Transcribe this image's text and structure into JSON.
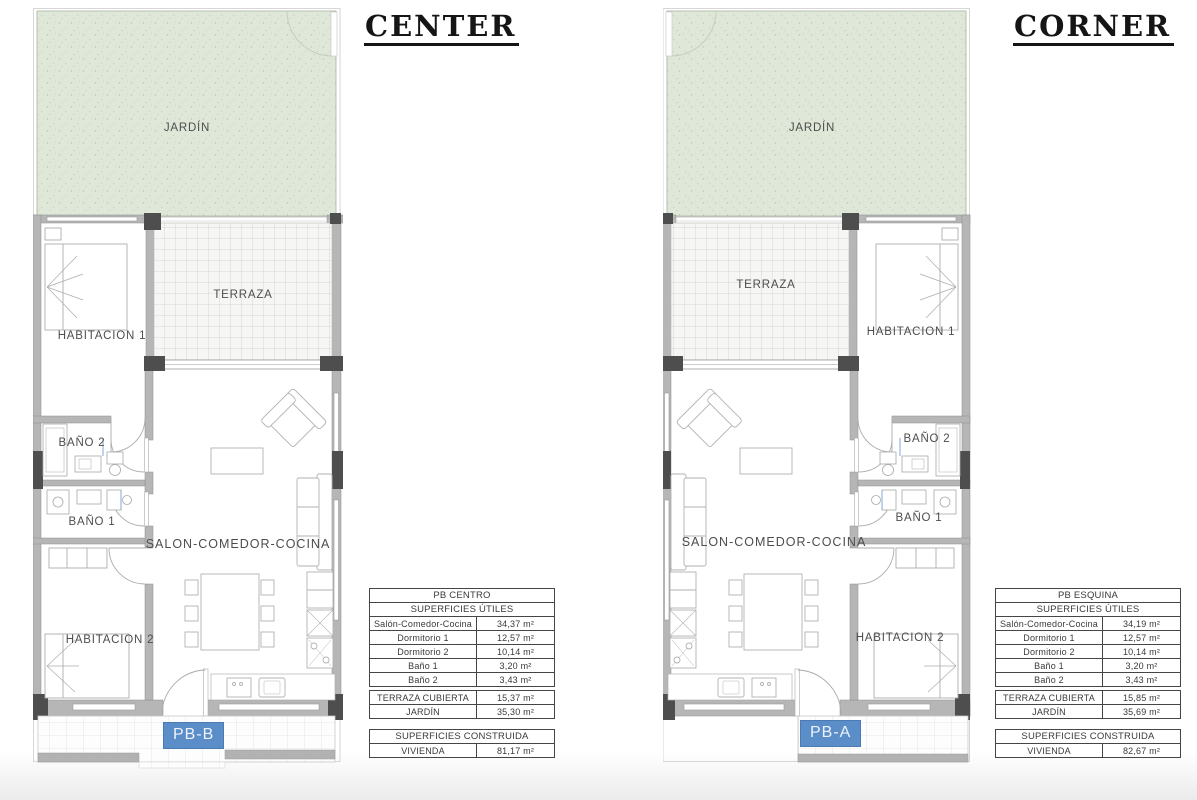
{
  "plans": {
    "center": {
      "title": "CENTER",
      "unit_label": "PB-B",
      "rooms": {
        "jardin": "JARDÍN",
        "terraza": "TERRAZA",
        "habitacion1": "HABITACION 1",
        "bano2": "BAÑO 2",
        "bano1": "BAÑO 1",
        "salon": "SALON-COMEDOR-COCINA",
        "habitacion2": "HABITACION 2"
      }
    },
    "corner": {
      "title": "CORNER",
      "unit_label": "PB-A",
      "rooms": {
        "jardin": "JARDÍN",
        "terraza": "TERRAZA",
        "habitacion1": "HABITACION 1",
        "bano2": "BAÑO 2",
        "bano1": "BAÑO 1",
        "salon": "SALON-COMEDOR-COCINA",
        "habitacion2": "HABITACION 2"
      }
    }
  },
  "tables": {
    "center": {
      "title": "PB CENTRO",
      "subtitle": "SUPERFICIES ÚTILES",
      "rows": [
        {
          "label": "Salón-Comedor-Cocina",
          "value": "34,37 m²"
        },
        {
          "label": "Dormitorio 1",
          "value": "12,57 m²"
        },
        {
          "label": "Dormitorio 2",
          "value": "10,14 m²"
        },
        {
          "label": "Baño 1",
          "value": "3,20 m²"
        },
        {
          "label": "Baño 2",
          "value": "3,43 m²"
        }
      ],
      "exterior_rows": [
        {
          "label": "TERRAZA CUBIERTA",
          "value": "15,37 m²"
        },
        {
          "label": "JARDÍN",
          "value": "35,30 m²"
        }
      ],
      "built_title": "SUPERFICIES CONSTRUIDA",
      "built_rows": [
        {
          "label": "VIVIENDA",
          "value": "81,17 m²"
        }
      ]
    },
    "corner": {
      "title": "PB ESQUINA",
      "subtitle": "SUPERFICIES ÚTILES",
      "rows": [
        {
          "label": "Salón-Comedor-Cocina",
          "value": "34,19 m²"
        },
        {
          "label": "Dormitorio 1",
          "value": "12,57 m²"
        },
        {
          "label": "Dormitorio 2",
          "value": "10,14 m²"
        },
        {
          "label": "Baño 1",
          "value": "3,20 m²"
        },
        {
          "label": "Baño 2",
          "value": "3,43 m²"
        }
      ],
      "exterior_rows": [
        {
          "label": "TERRAZA CUBIERTA",
          "value": "15,85 m²"
        },
        {
          "label": "JARDÍN",
          "value": "35,69 m²"
        }
      ],
      "built_title": "SUPERFICIES CONSTRUIDA",
      "built_rows": [
        {
          "label": "VIVIENDA",
          "value": "82,67 m²"
        }
      ]
    }
  },
  "colors": {
    "garden_green": "#dfe8d8",
    "unit_label_blue": "#5b8ec9",
    "wall_gray": "#b6b6b6",
    "wall_dark": "#4e4e4e"
  }
}
